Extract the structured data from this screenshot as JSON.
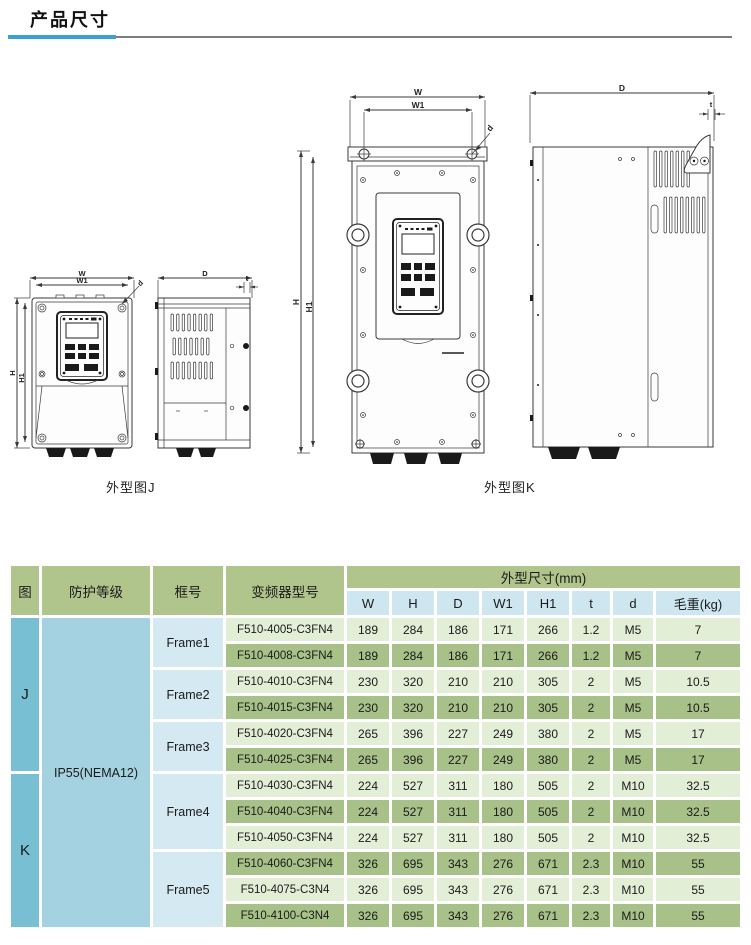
{
  "page": {
    "title": "产品尺寸"
  },
  "figures": {
    "caption_j": "外型图J",
    "caption_k": "外型图K",
    "dims": {
      "w": "W",
      "w1": "W1",
      "h": "H",
      "h1": "H1",
      "depth": "D",
      "t": "t",
      "d": "d"
    }
  },
  "table": {
    "header": {
      "figure": "图",
      "protection": "防护等级",
      "frame": "框号",
      "model": "变频器型号",
      "dims_group": "外型尺寸(mm)",
      "cols": [
        "W",
        "H",
        "D",
        "W1",
        "H1",
        "t",
        "d",
        "毛重(kg)"
      ]
    },
    "figure_j": "J",
    "figure_k": "K",
    "protection": "IP55(NEMA12)",
    "frames": [
      "Frame1",
      "Frame2",
      "Frame3",
      "Frame4",
      "Frame5"
    ],
    "rows": [
      {
        "model": "F510-4005-C3FN4",
        "values": [
          "189",
          "284",
          "186",
          "171",
          "266",
          "1.2",
          "M5",
          "7"
        ]
      },
      {
        "model": "F510-4008-C3FN4",
        "values": [
          "189",
          "284",
          "186",
          "171",
          "266",
          "1.2",
          "M5",
          "7"
        ]
      },
      {
        "model": "F510-4010-C3FN4",
        "values": [
          "230",
          "320",
          "210",
          "210",
          "305",
          "2",
          "M5",
          "10.5"
        ]
      },
      {
        "model": "F510-4015-C3FN4",
        "values": [
          "230",
          "320",
          "210",
          "210",
          "305",
          "2",
          "M5",
          "10.5"
        ]
      },
      {
        "model": "F510-4020-C3FN4",
        "values": [
          "265",
          "396",
          "227",
          "249",
          "380",
          "2",
          "M5",
          "17"
        ]
      },
      {
        "model": "F510-4025-C3FN4",
        "values": [
          "265",
          "396",
          "227",
          "249",
          "380",
          "2",
          "M5",
          "17"
        ]
      },
      {
        "model": "F510-4030-C3FN4",
        "values": [
          "224",
          "527",
          "311",
          "180",
          "505",
          "2",
          "M10",
          "32.5"
        ]
      },
      {
        "model": "F510-4040-C3FN4",
        "values": [
          "224",
          "527",
          "311",
          "180",
          "505",
          "2",
          "M10",
          "32.5"
        ]
      },
      {
        "model": "F510-4050-C3FN4",
        "values": [
          "224",
          "527",
          "311",
          "180",
          "505",
          "2",
          "M10",
          "32.5"
        ]
      },
      {
        "model": "F510-4060-C3FN4",
        "values": [
          "326",
          "695",
          "343",
          "276",
          "671",
          "2.3",
          "M10",
          "55"
        ]
      },
      {
        "model": "F510-4075-C3N4",
        "values": [
          "326",
          "695",
          "343",
          "276",
          "671",
          "2.3",
          "M10",
          "55"
        ]
      },
      {
        "model": "F510-4100-C3N4",
        "values": [
          "326",
          "695",
          "343",
          "276",
          "671",
          "2.3",
          "M10",
          "55"
        ]
      }
    ]
  },
  "colors": {
    "accent_blue": "#3aa0d8",
    "header_green": "#afc58c",
    "subheader_blue": "#cde6f0",
    "figure_cyan": "#79bfd3",
    "protection_blue": "#a5d2e0",
    "frame_blue": "#d4e9f1",
    "row_light": "#e3eed6",
    "row_green": "#a7c189"
  }
}
